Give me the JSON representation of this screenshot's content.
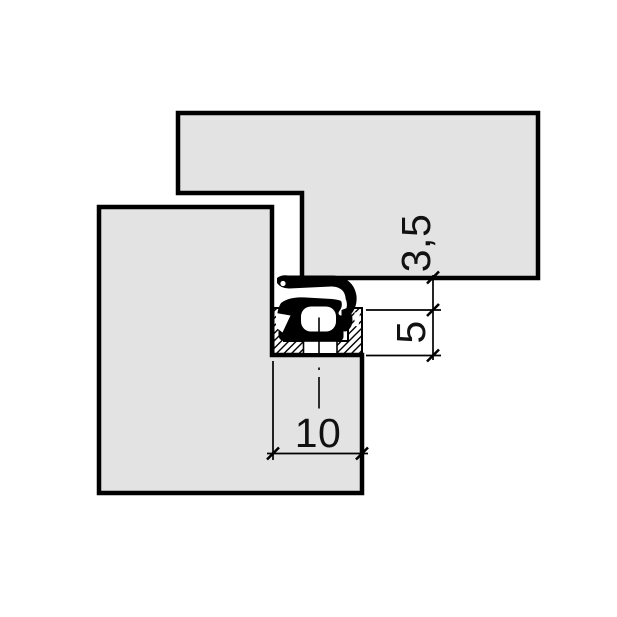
{
  "drawing": {
    "labels": {
      "dim_gap": "3,5",
      "dim_groove_depth": "5",
      "dim_groove_width": "10"
    },
    "colors": {
      "material_fill": "#e3e3e3",
      "seal_fill": "#000000",
      "outline": "#000000",
      "background": "#ffffff"
    }
  }
}
